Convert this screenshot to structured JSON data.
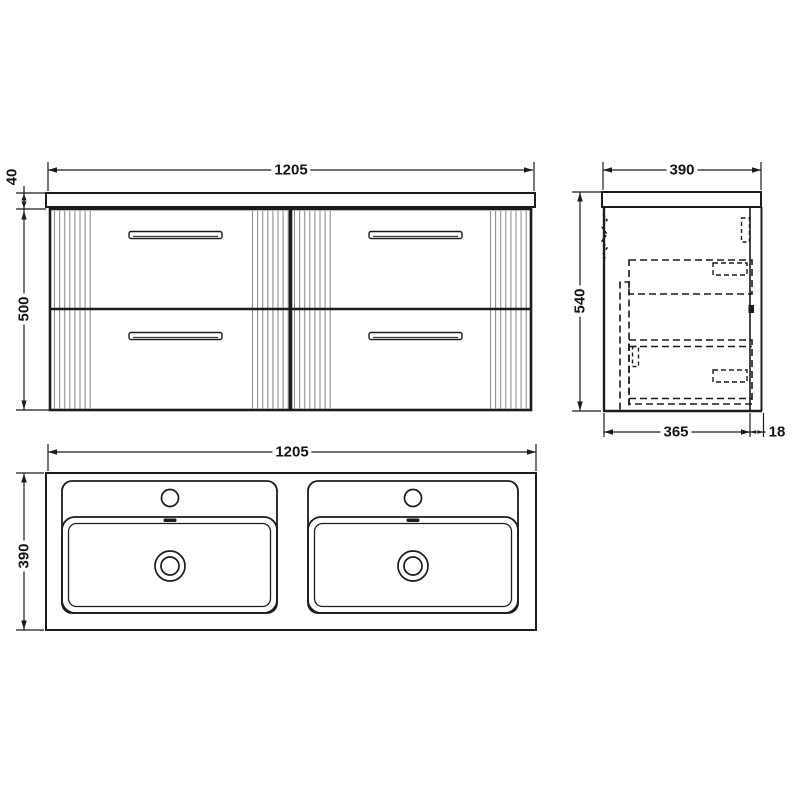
{
  "colors": {
    "line": "#1c1c1c",
    "flute": "#8f8f8f",
    "background": "#ffffff"
  },
  "front_view": {
    "width": "1205",
    "worktop_thickness": "40",
    "cabinet_height": "500"
  },
  "side_view": {
    "depth": "390",
    "height": "540",
    "carcass_depth": "365",
    "back_panel_gap": "18"
  },
  "plan_view": {
    "width": "1205",
    "depth": "390"
  }
}
